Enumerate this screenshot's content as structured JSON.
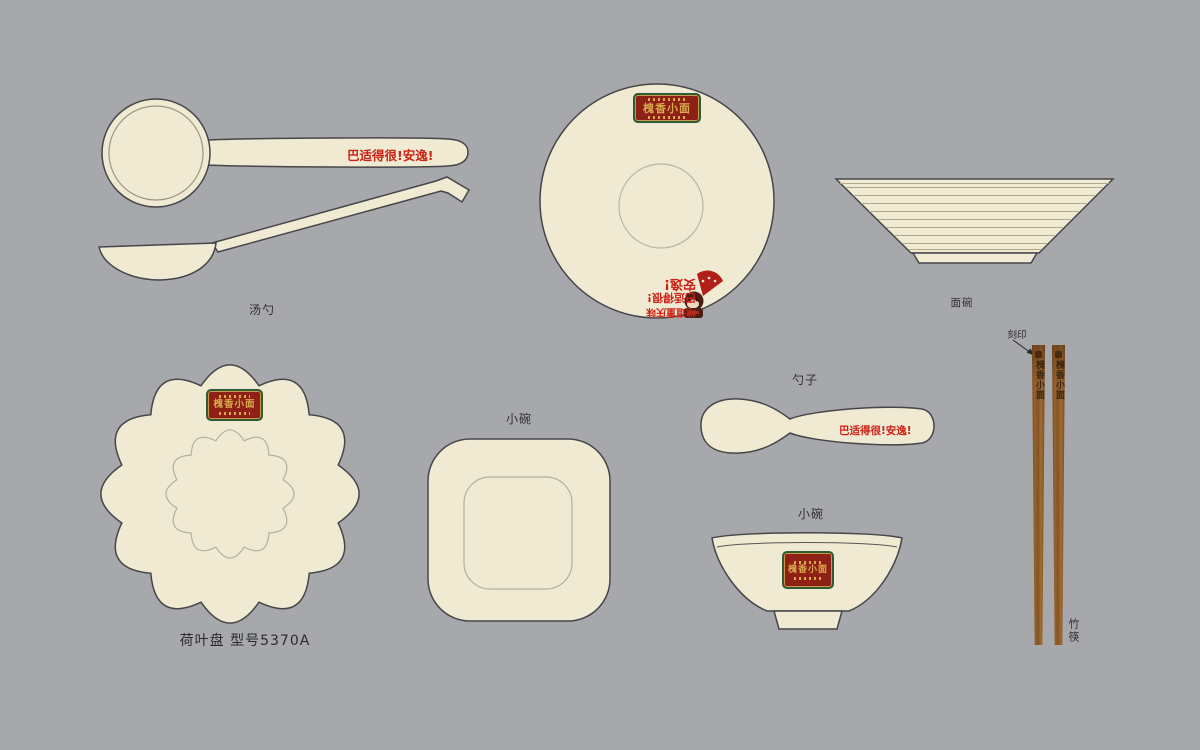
{
  "background_color": "#a6a8ab",
  "brand": {
    "name": "槐香小面",
    "badge": {
      "red": "#8e2016",
      "green": "#2f5a35",
      "gold": "#d9a94e"
    }
  },
  "slogan": "巴适得很!安逸!",
  "items": {
    "soup_ladle": {
      "label": "汤勺",
      "handle_text": "巴适得很!安逸!"
    },
    "noodle_bowl_top": {
      "interior_text": {
        "line1": "地道重庆味",
        "line2": "巴适得很!",
        "line3": "安逸!"
      }
    },
    "noodle_bowl_side": {
      "label": "面碗"
    },
    "spoon": {
      "label": "勺子",
      "handle_text": "巴适得很!安逸!"
    },
    "square_bowl": {
      "label": "小碗"
    },
    "small_bowl": {
      "label": "小碗"
    },
    "lotus_plate": {
      "label": "荷叶盘 型号5370A"
    },
    "chopsticks": {
      "label": "竹筷",
      "engrave_label": "刻印",
      "engraving": "槐香小面"
    }
  },
  "colors": {
    "ceramic": "#f0ead3",
    "outline": "#46464a",
    "detail_line": "#b4ae9c",
    "slogan_red": "#cf2015",
    "label_text": "#303033",
    "wood": "#8a5527"
  }
}
